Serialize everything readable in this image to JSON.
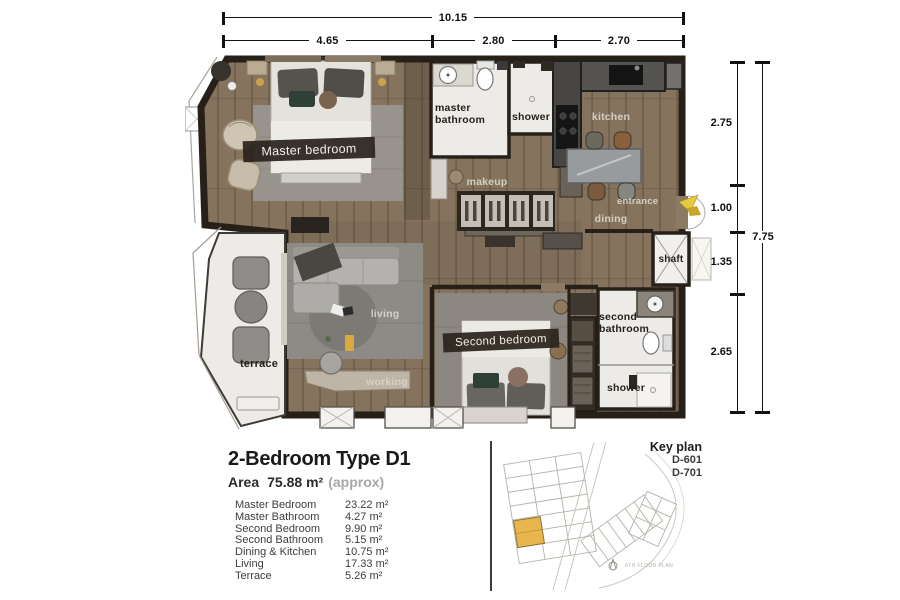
{
  "dimensions": {
    "top": {
      "total": "10.15",
      "segments": [
        "4.65",
        "2.80",
        "2.70"
      ]
    },
    "right": {
      "total": "7.75",
      "segments": [
        "2.75",
        "1.00",
        "1.35",
        "2.65"
      ]
    }
  },
  "plan": {
    "rooms": {
      "master_bedroom": "Master bedroom",
      "master_bathroom": "master bathroom",
      "shower_master": "shower",
      "kitchen": "kitchen",
      "makeup": "makeup",
      "entrance": "entrance",
      "dining": "dining",
      "shaft": "shaft",
      "living": "living",
      "working": "working",
      "terrace": "terrace",
      "second_bedroom": "Second bedroom",
      "second_bathroom": "second bathroom",
      "shower_second": "shower"
    }
  },
  "info": {
    "title": "2-Bedroom Type D1",
    "area_label": "Area",
    "area_value": "75.88 m²",
    "area_note": "(approx)",
    "rooms": [
      {
        "name": "Master Bedroom",
        "area": "23.22 m²"
      },
      {
        "name": "Master Bathroom",
        "area": "4.27 m²"
      },
      {
        "name": "Second Bedroom",
        "area": "9.90 m²"
      },
      {
        "name": "Second Bathroom",
        "area": "5.15 m²"
      },
      {
        "name": "Dining & Kitchen",
        "area": "10.75 m²"
      },
      {
        "name": "Living",
        "area": "17.33 m²"
      },
      {
        "name": "Terrace",
        "area": "5.26 m²"
      }
    ]
  },
  "keyplan": {
    "title": "Key plan",
    "units": [
      "D-601",
      "D-701"
    ],
    "caption": "6TH FLOOR PLAN",
    "highlight_color": "#e9b64d"
  },
  "colors": {
    "wall": "#262019",
    "wood_floor": "#85735e",
    "white_floor": "#edebe7",
    "accent_yellow": "#e8ca3e",
    "keyplan_highlight": "#e9b64d"
  }
}
